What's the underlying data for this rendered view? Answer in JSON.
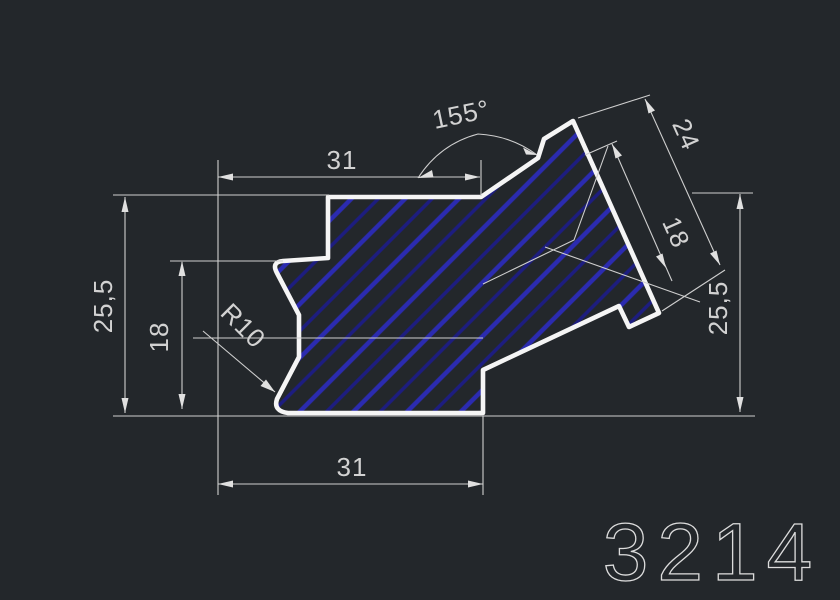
{
  "canvas": {
    "background": "#23272b"
  },
  "part": {
    "number": "3214",
    "outline_color": "#f5f5f5",
    "hatch_color_bright": "#2b2bb0",
    "hatch_color_dark": "#1d1d80"
  },
  "dims": {
    "top_width": "31",
    "bottom_width": "31",
    "left_height": "25,5",
    "right_height": "25,5",
    "left_step_height": "18",
    "flange_depth": "24",
    "flange_inner_depth": "18",
    "angle": "155°",
    "corner_radius": "R10"
  }
}
